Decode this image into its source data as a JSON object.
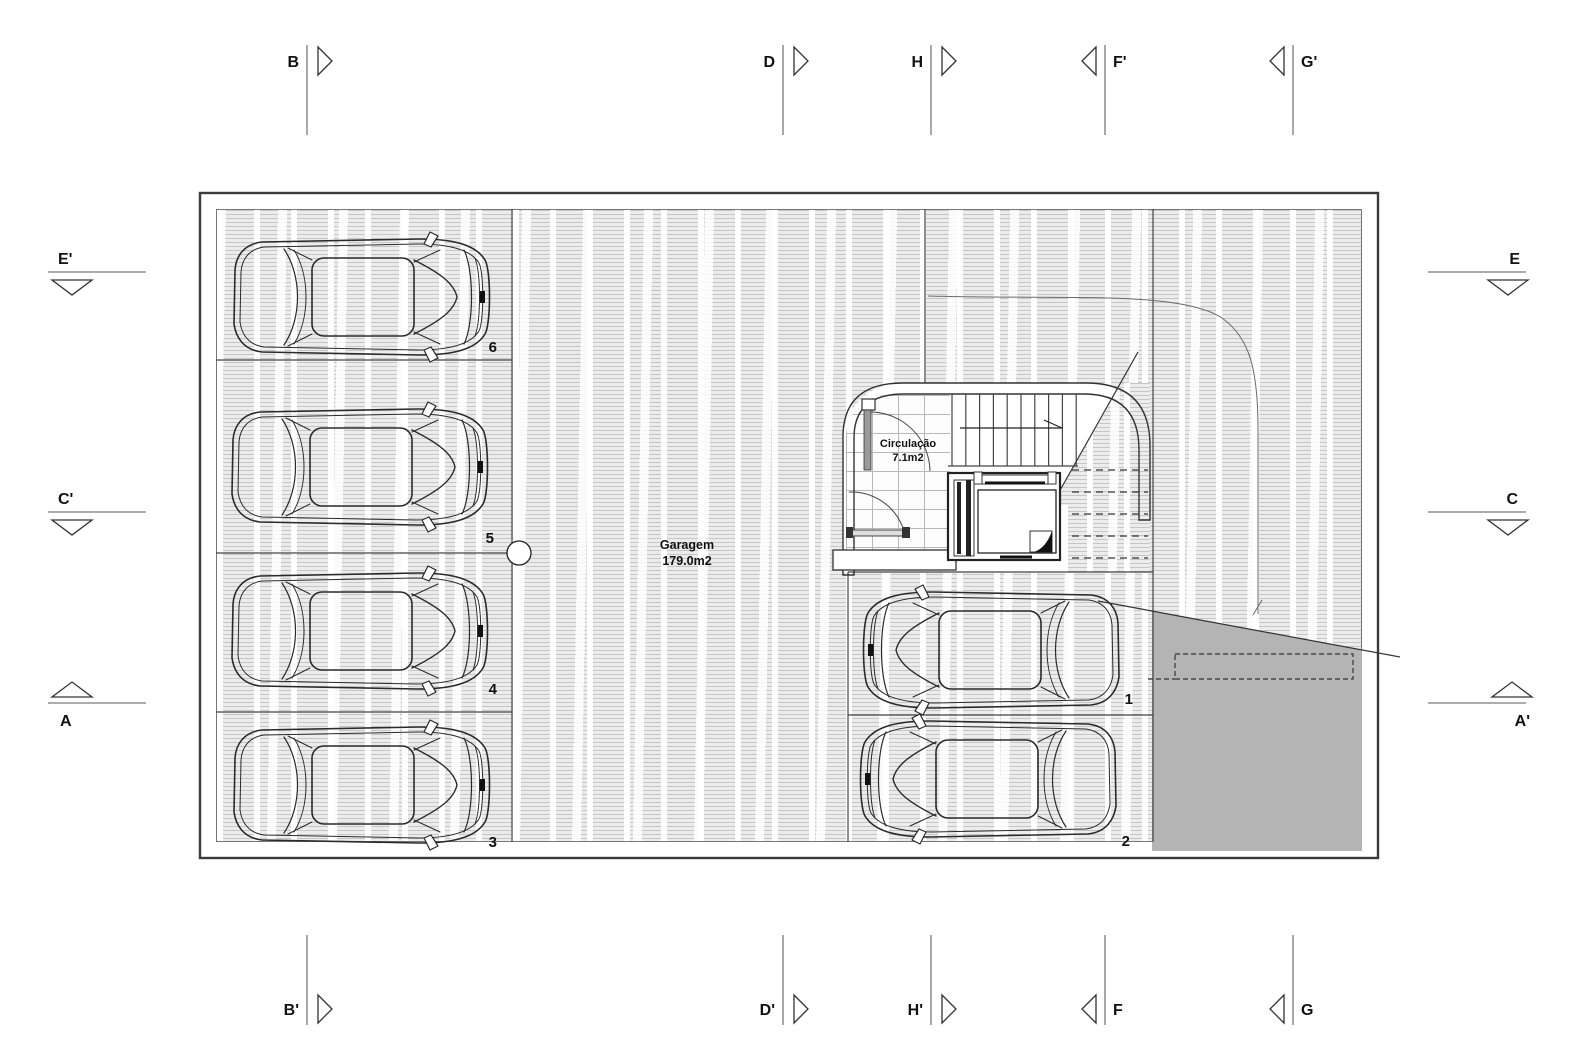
{
  "document": {
    "type": "architectural-floor-plan",
    "level": "garage"
  },
  "labels": {
    "garage_name": "Garagem",
    "garage_area": "179.0m2",
    "circulation_name": "Circulação",
    "circulation_area": "7.1m2"
  },
  "parking_spaces": [
    {
      "label": "1"
    },
    {
      "label": "2"
    },
    {
      "label": "3"
    },
    {
      "label": "4"
    },
    {
      "label": "5"
    },
    {
      "label": "6"
    }
  ],
  "section_markers": {
    "top": [
      {
        "label": "B"
      },
      {
        "label": "D"
      },
      {
        "label": "H"
      },
      {
        "label": "F'"
      },
      {
        "label": "G'"
      }
    ],
    "bottom": [
      {
        "label": "B'"
      },
      {
        "label": "D'"
      },
      {
        "label": "H'"
      },
      {
        "label": "F"
      },
      {
        "label": "G"
      }
    ],
    "left": [
      {
        "label": "E'"
      },
      {
        "label": "C'"
      },
      {
        "label": "A"
      }
    ],
    "right": [
      {
        "label": "E"
      },
      {
        "label": "C"
      },
      {
        "label": "A'"
      }
    ]
  },
  "colors": {
    "ramp_fill": "#b4b4b4",
    "floor_tint": "#ececec",
    "line": "#1a1a1a"
  }
}
